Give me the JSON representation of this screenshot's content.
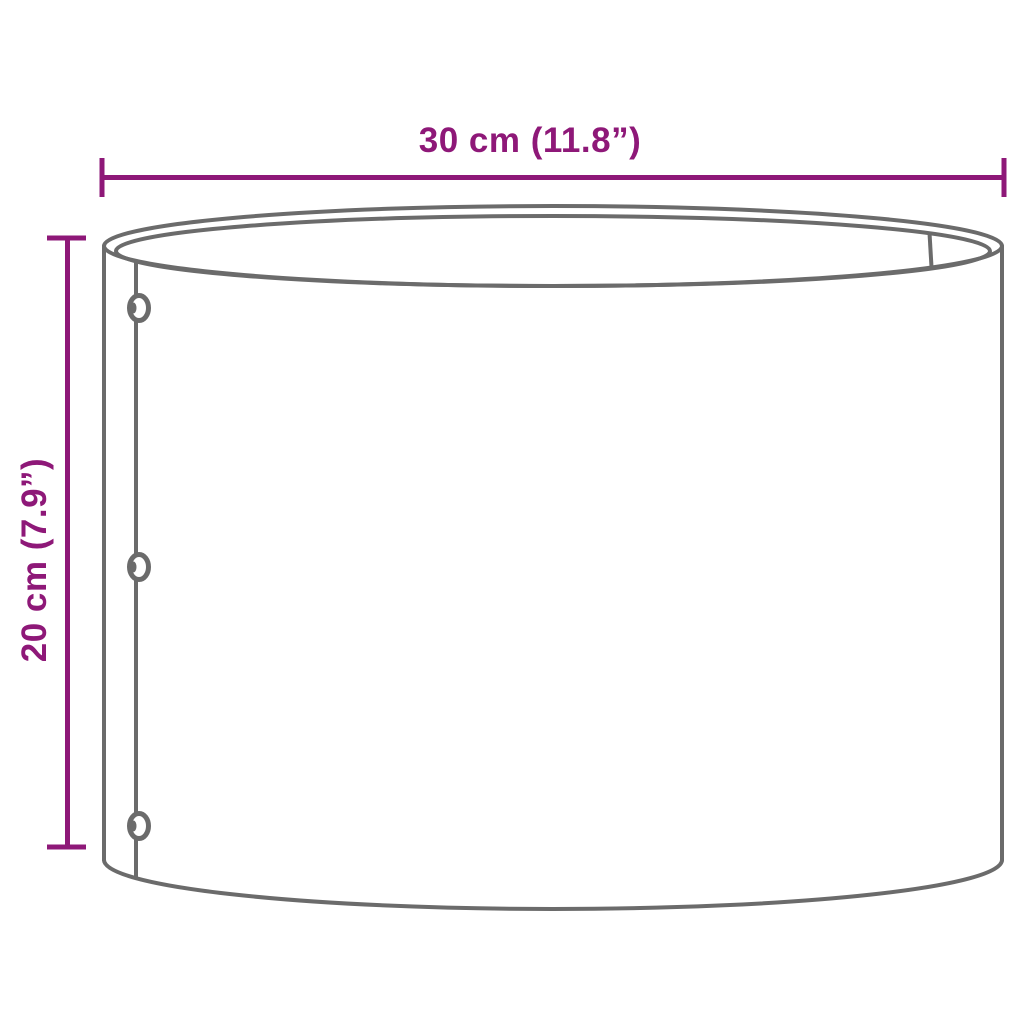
{
  "colors": {
    "dimension_accent": "#8e1878",
    "outline": "#6b6b6b",
    "background": "#ffffff"
  },
  "dimensions": {
    "width": {
      "label": "30 cm (11.8”)"
    },
    "height": {
      "label": "20 cm (7.9”)"
    }
  },
  "illustration": {
    "subject": "open-top cylindrical planter with riveted side seam",
    "rivet_count": 3
  }
}
